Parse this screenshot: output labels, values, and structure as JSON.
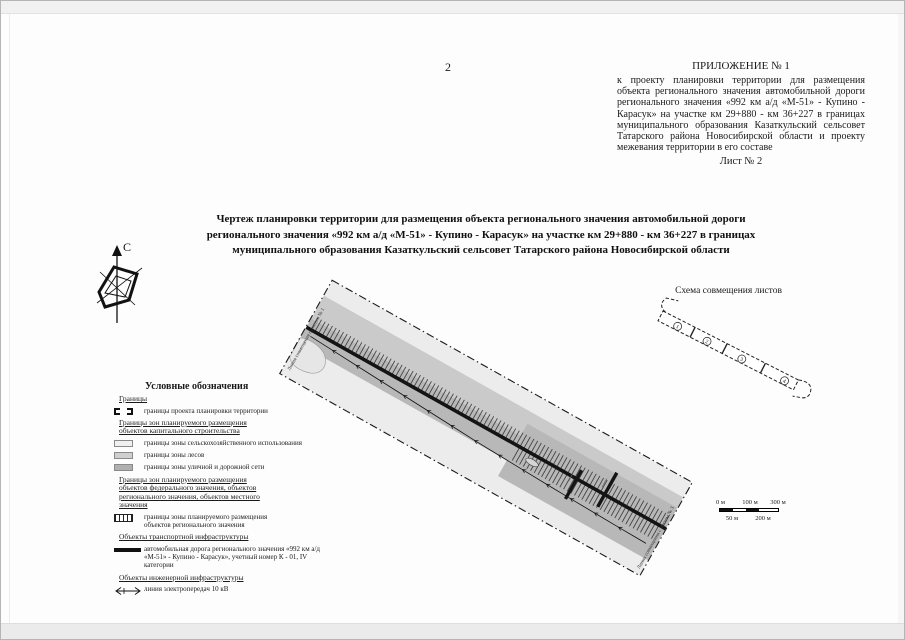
{
  "page": {
    "number": "2"
  },
  "appendix": {
    "title": "ПРИЛОЖЕНИЕ № 1",
    "body": "к проекту планировки территории для размещения объекта регионального значения автомобильной дороги регионального значения «992 км а/д «М-51» - Купино - Карасук» на участке км 29+880 - км 36+227 в границах муниципального образования Казаткульский сельсовет Татарского района Новосибирской области и проекту межевания территории в его составе",
    "sheet_label": "Лист № 2"
  },
  "title": "Чертеж планировки  территории  для размещения объекта регионального значения автомобильной дороги регионального значения «992 км а/д «М-51» - Купино - Карасук» на участке км 29+880 - км 36+227 в границах муниципального образования Казаткульский сельсовет Татарского района Новосибирской области",
  "compass": {
    "north_label": "С"
  },
  "scheme": {
    "title": "Схема совмещения листов",
    "sheets": [
      "1",
      "2",
      "3",
      "4"
    ]
  },
  "plan": {
    "edge_label_start": "Линия совмещения с листом № 1",
    "edge_label_end": "Линия совмещения с листом № 3",
    "colors": {
      "agriculture_zone": "#ececec",
      "forest_zone": "#cacaca",
      "road_network_zone": "#b8b8b8",
      "road": "#141414"
    }
  },
  "legend": {
    "heading": "Условные обозначения",
    "sections": {
      "borders": "Границы",
      "capital_zones": "Границы зон планируемого размещения объектов капитального строительства",
      "regional_zones": "Границы зон планируемого размещения объектов федерального значения, объектов регионального значения, объектов местного значения",
      "transport": "Объекты транспортной инфраструктуры",
      "engineering": "Объекты инженерной инфраструктуры"
    },
    "items": {
      "project_boundary": "границы проекта планировки территории",
      "agriculture": "границы зоны сельскохозяйственного использования",
      "forest": "границы зоны лесов",
      "road_network": "границы зоны уличной и дорожной сети",
      "regional_placement": "границы зоны планируемого размещения объектов регионального значения",
      "road": "автомобильная дорога регионального значения «992 км а/д «М-51» - Купино - Карасук», учетный номер К - 01,  IV категории",
      "power_line": "линия электропередач 10 кВ"
    }
  },
  "scale_bar": {
    "labels_top": [
      "0 м",
      "100 м",
      "300 м"
    ],
    "labels_bottom": [
      "50 м",
      "200 м"
    ]
  }
}
